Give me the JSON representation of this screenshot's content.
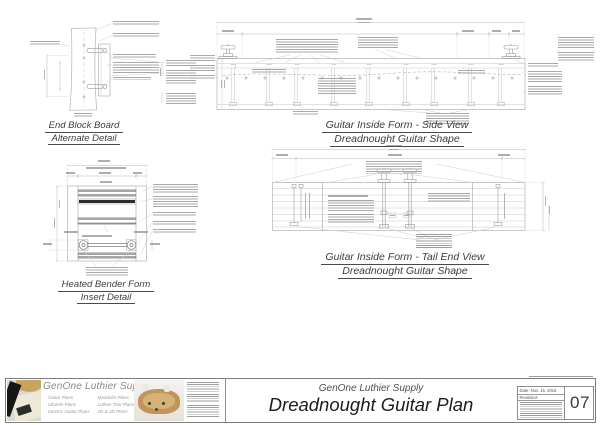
{
  "document": {
    "type": "technical drawing sheet",
    "colors": {
      "paper": "#ffffff",
      "linework": "#b2b2b2",
      "dark_detail": "#555555",
      "title_text": "#3d3d3d",
      "plan_title_text": "#1c1c1c",
      "wood_photo": "#c0955c",
      "logo_tan": "#c7a55e"
    }
  },
  "views": {
    "end_block": {
      "title_line1": "End Block Board",
      "title_line2": "Alternate Detail"
    },
    "side": {
      "title_line1": "Guitar Inside Form - Side View",
      "title_line2": "Dreadnought Guitar Shape"
    },
    "bender": {
      "title_line1": "Heated Bender Form",
      "title_line2": "Insert Detail"
    },
    "tail": {
      "title_line1": "Guitar Inside Form - Tail End View",
      "title_line2": "Dreadnought Guitar Shape"
    }
  },
  "title_block": {
    "brand": "GenOne Luthier Supplies",
    "categories_col1": [
      "Guitar Plans",
      "Ukulele Plans",
      "Electric Guitar Plans"
    ],
    "categories_col2": [
      "Mandolin Plans",
      "Luthier Tool Plans",
      "2D & 3D Plans"
    ],
    "company": "GenOne Luthier Supply",
    "plan_title": "Dreadnought Guitar Plan",
    "date": "Date: Nov. 15, 2016",
    "revisions_label": "Revisions",
    "sheet_number": "07"
  }
}
